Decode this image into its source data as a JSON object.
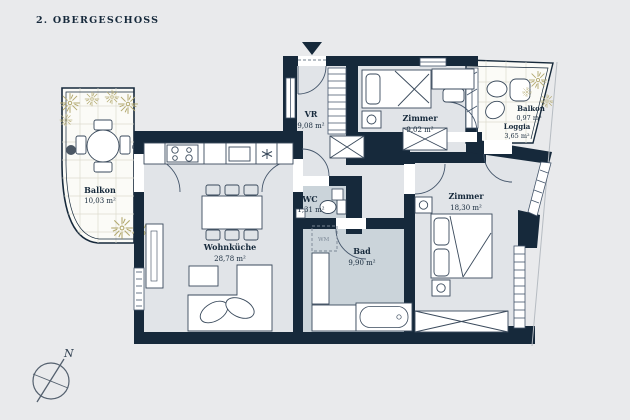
{
  "title": "2. OBERGESCHOSS",
  "compass": {
    "north_label": "N"
  },
  "annotations": {
    "washing_machine": "WM"
  },
  "colors": {
    "background": "#e9eaec",
    "wall": "#16293b",
    "room_fill": "#e1e4e8",
    "wet_room_fill": "#cbd4da",
    "balcony_fill": "#fbfbf7",
    "plant": "#b3a96f",
    "furniture_line": "#3a4a5c"
  },
  "rooms": [
    {
      "id": "balkon-left",
      "name": "Balkon",
      "area": "10,03 m²"
    },
    {
      "id": "wohnkueche",
      "name": "Wohnküche",
      "area": "28,78 m²"
    },
    {
      "id": "vr",
      "name": "VR",
      "area": "9,08 m²"
    },
    {
      "id": "wc",
      "name": "WC",
      "area": "1,31 m²"
    },
    {
      "id": "bad",
      "name": "Bad",
      "area": "9,90 m²"
    },
    {
      "id": "zimmer-klein",
      "name": "Zimmer",
      "area": "9,02 m²"
    },
    {
      "id": "zimmer-gross",
      "name": "Zimmer",
      "area": "18,30 m²"
    },
    {
      "id": "balkon-right",
      "name": "Balkon",
      "area": "0,97 m²"
    },
    {
      "id": "loggia",
      "name": "Loggia",
      "area": "3,65 m²"
    }
  ]
}
